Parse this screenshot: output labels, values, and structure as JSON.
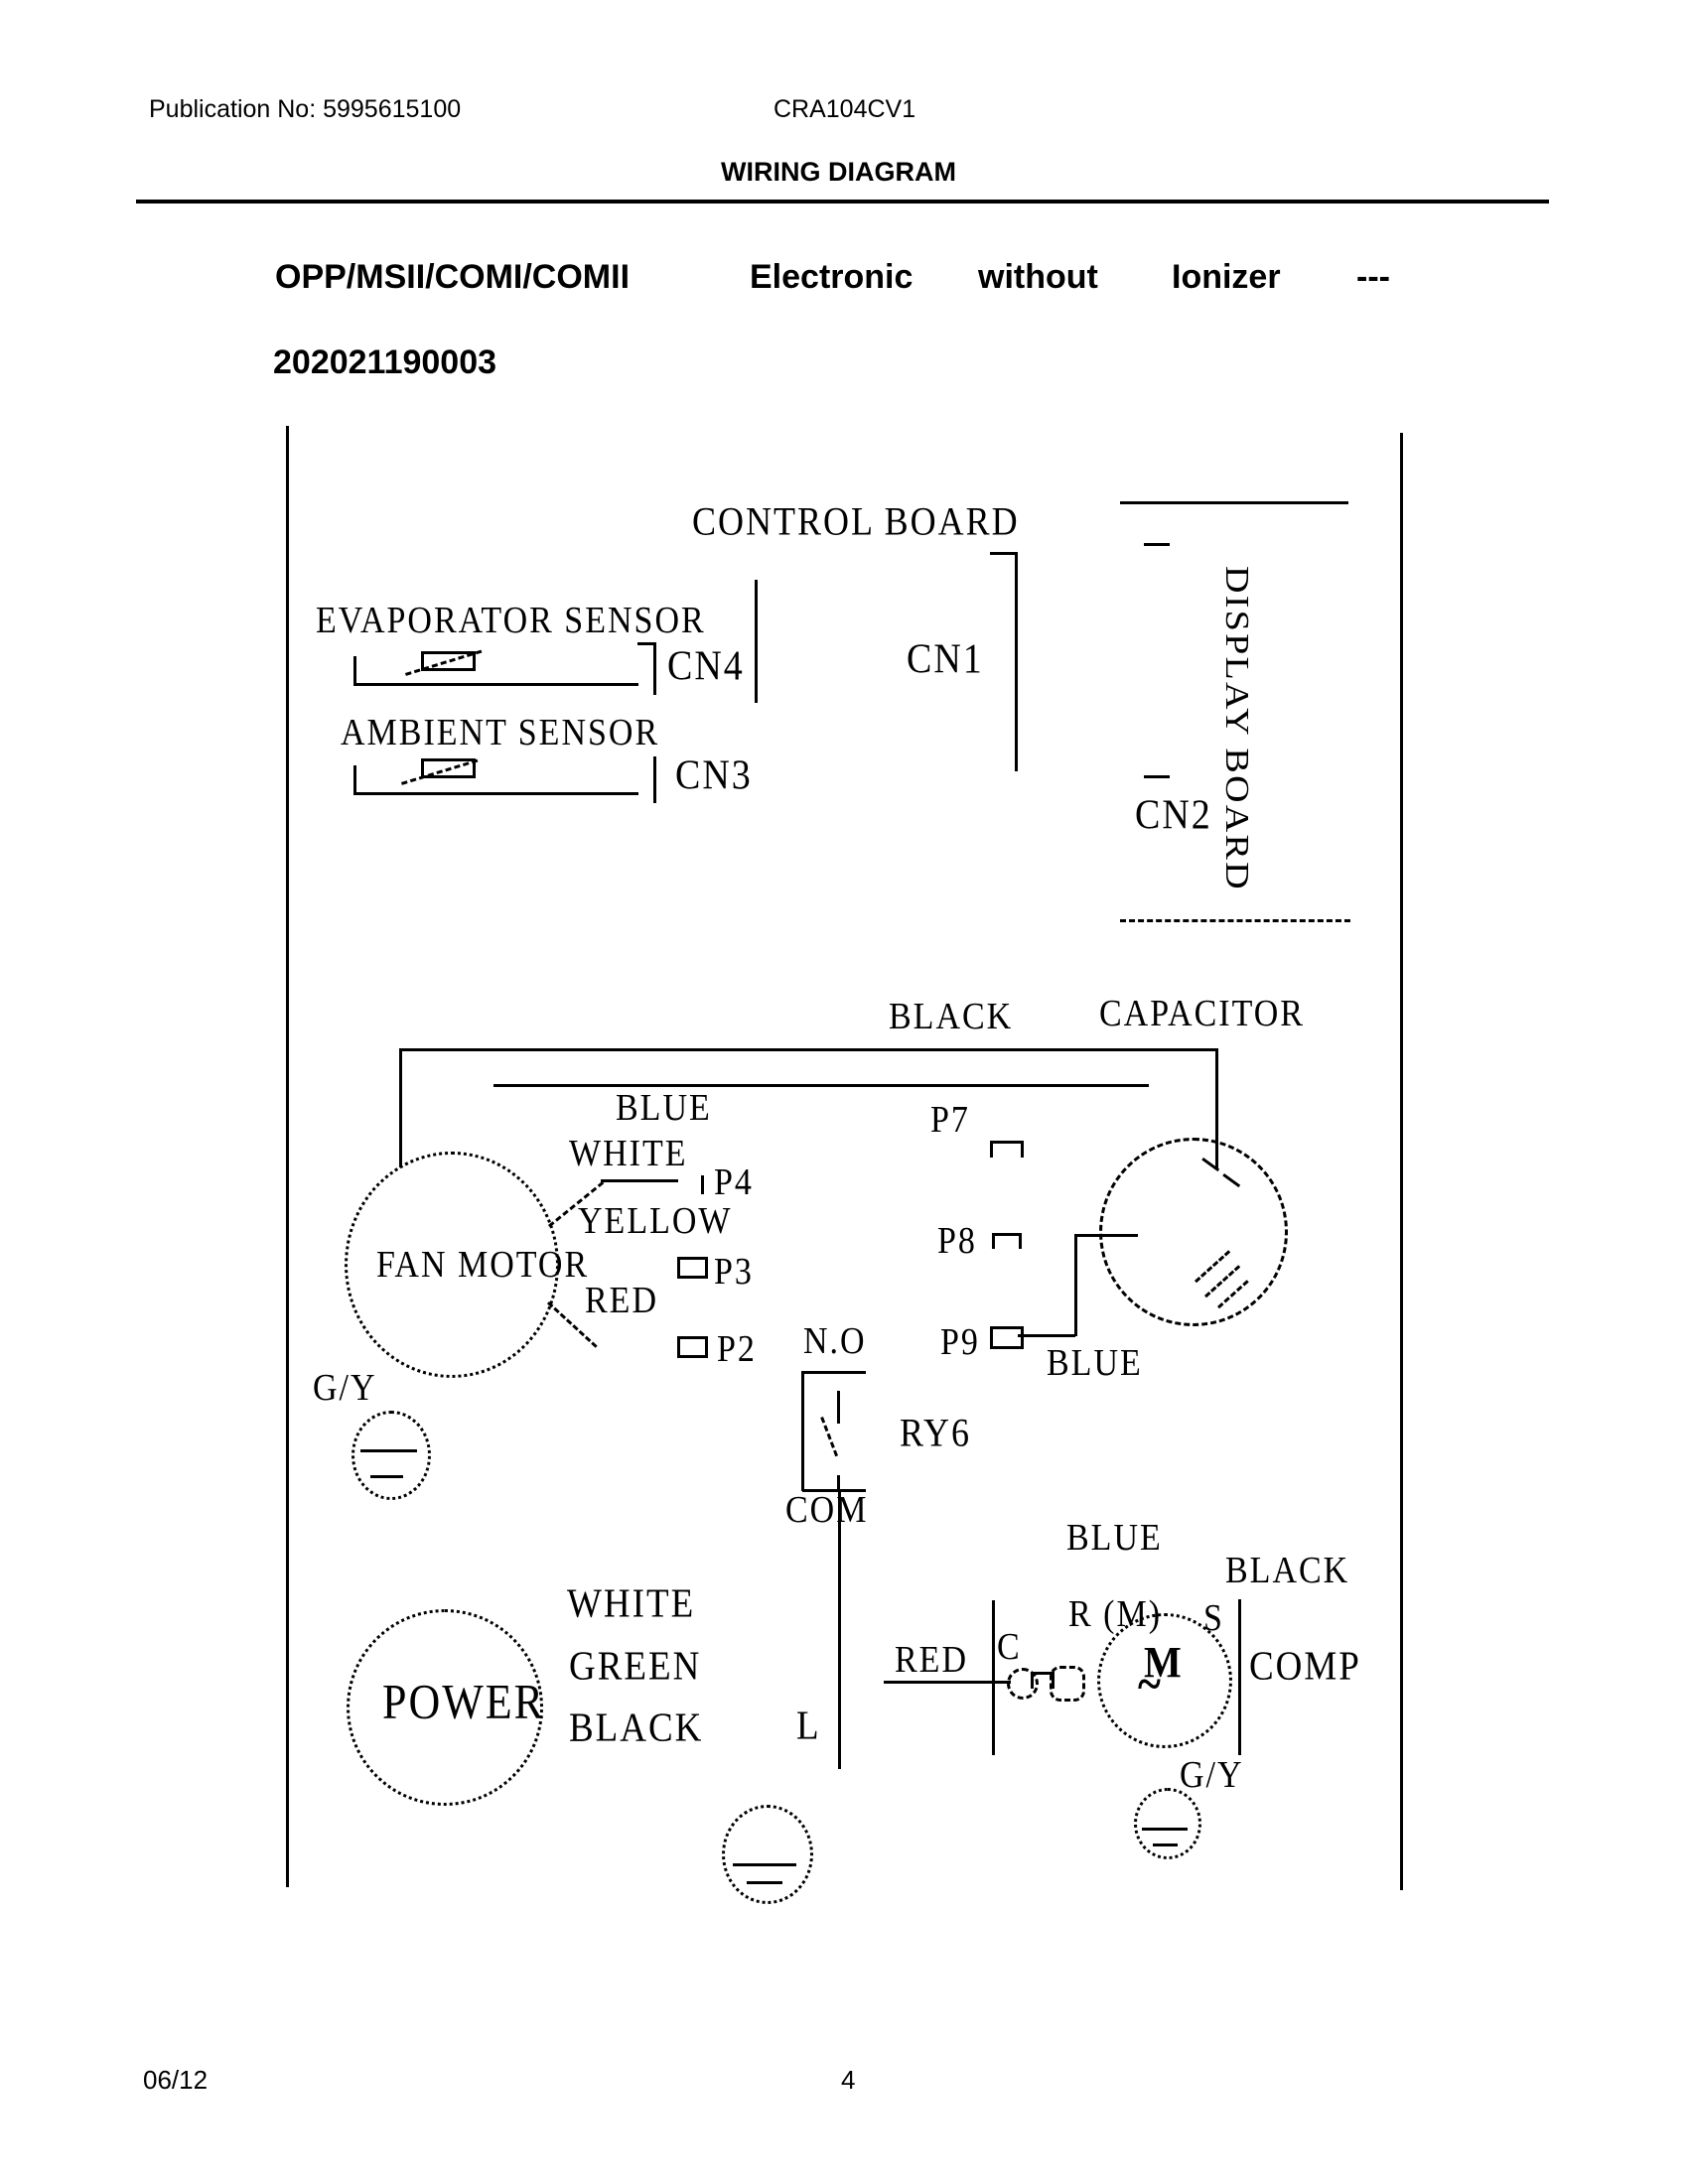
{
  "header": {
    "publication_no": "Publication No: 5995615100",
    "model": "CRA104CV1",
    "page_title": "WIRING DIAGRAM"
  },
  "title": {
    "words": [
      "OPP/MSII/COMI/COMII",
      "Electronic",
      "without",
      "Ionizer",
      "---"
    ],
    "code": "202021190003"
  },
  "diagram": {
    "boards": {
      "control": "CONTROL BOARD",
      "display": "DISPLAY BOARD"
    },
    "connectors": {
      "cn1": "CN1",
      "cn2": "CN2",
      "cn3": "CN3",
      "cn4": "CN4"
    },
    "sensors": {
      "evaporator": "EVAPORATOR SENSOR",
      "ambient": "AMBIENT SENSOR"
    },
    "pins": {
      "p2": "P2",
      "p3": "P3",
      "p4": "P4",
      "p7": "P7",
      "p8": "P8",
      "p9": "P9"
    },
    "components": {
      "fan_motor": "FAN MOTOR",
      "capacitor": "CAPACITOR",
      "power": "POWER",
      "compressor": "COMP",
      "compressor_motor": "M",
      "compressor_motor_wave": "~",
      "relay": "RY6"
    },
    "relay": {
      "normally_open": "N.O",
      "common": "COM",
      "line": "L"
    },
    "compressor_terminals": {
      "run": "R (M)",
      "start": "S",
      "common": "C"
    },
    "wire_colors": {
      "black": "BLACK",
      "blue": "BLUE",
      "white": "WHITE",
      "yellow": "YELLOW",
      "red": "RED",
      "green": "GREEN",
      "ground": "G/Y"
    }
  },
  "footer": {
    "revision": "06/12",
    "page_number": "4"
  }
}
